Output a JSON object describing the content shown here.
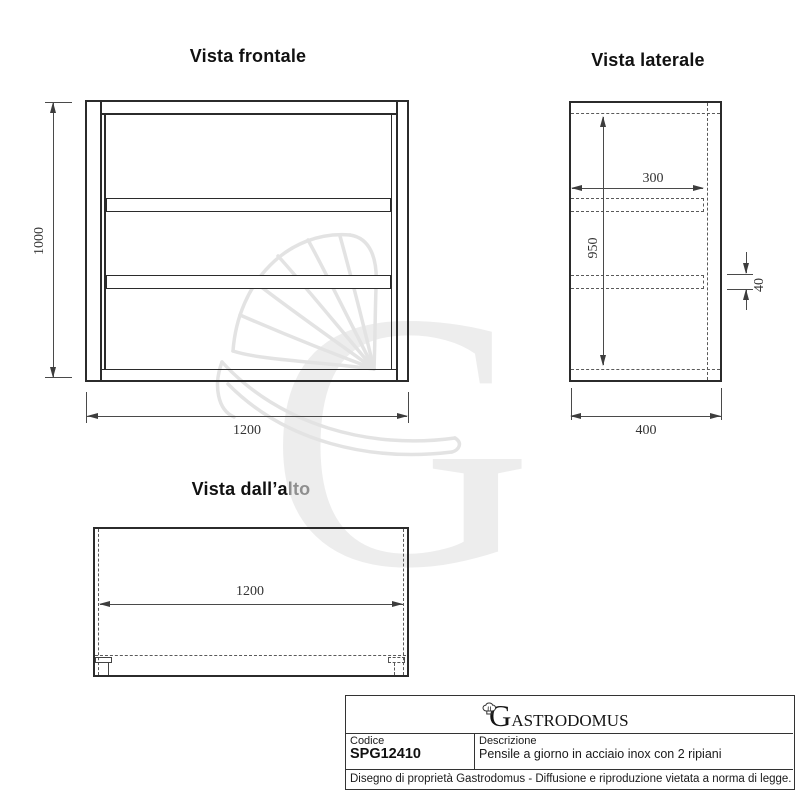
{
  "views": {
    "front": {
      "title": "Vista frontale",
      "dim_height": "1000",
      "dim_width": "1200"
    },
    "side": {
      "title": "Vista laterale",
      "dim_shelf_depth": "300",
      "dim_inner_height": "950",
      "dim_shelf_thickness": "40",
      "dim_depth": "400"
    },
    "top": {
      "title_dark": "Vista dall’a",
      "title_faded": "lto",
      "dim_width": "1200"
    }
  },
  "title_block": {
    "brand_initial": "G",
    "brand_rest": "ASTRODOMUS",
    "codice_label": "Codice",
    "codice_value": "SPG12410",
    "descrizione_label": "Descrizione",
    "descrizione_value": "Pensile a giorno in acciaio inox con 2 ripiani",
    "footer": "Disegno di proprietà Gastrodomus -  Diffusione e riproduzione vietata a norma di legge."
  },
  "watermark": {
    "letter": "G"
  },
  "colors": {
    "line": "#2b2b2b",
    "dimension": "#4a4a4a",
    "watermark": "#ededed"
  }
}
